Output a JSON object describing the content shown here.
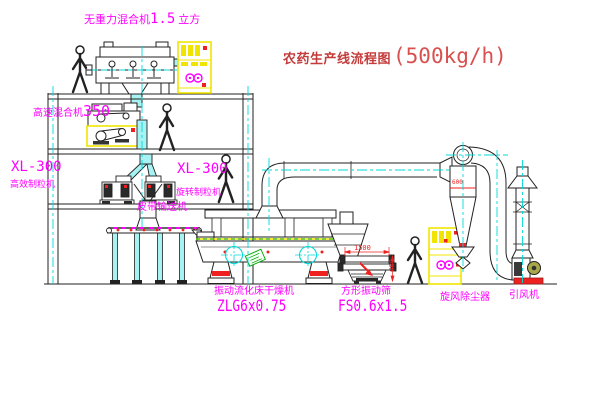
{
  "diagram": {
    "title": {
      "name_cn": "农药生产线流程图",
      "capacity": "(500kg/h)"
    },
    "equipment": {
      "gravity_mixer": {
        "label": "无重力混合机",
        "spec": "1.5",
        "unit": "立方"
      },
      "high_speed_mixer": {
        "label": "高速混合机",
        "spec": "350"
      },
      "granulator_left": {
        "model": "XL-300",
        "label": "高效制粒机"
      },
      "granulator_center": {
        "model": "XL-300",
        "label": "旋转制粒机"
      },
      "belt_conveyor": {
        "label": "皮带输送机"
      },
      "fluid_bed_dryer": {
        "label": "振动流化床干燥机",
        "model": "ZLG6x0.75"
      },
      "vibrating_sieve": {
        "label": "方形振动筛",
        "model": "FS0.6x1.5"
      },
      "cyclone": {
        "label": "旋风除尘器"
      },
      "induced_fan": {
        "label": "引风机"
      }
    },
    "dimensions": {
      "sieve_length": "1500",
      "sieve_width": "600",
      "cyclone_dia": "600"
    },
    "workers_count": 4,
    "colors": {
      "label": "#ff00ff",
      "title": "#d85050",
      "pipe_fill": "#a7f3f3",
      "centerline": "#00d9d9",
      "cabinet": "#f0e400",
      "accent": "#ee2020",
      "line": "#222222"
    }
  }
}
